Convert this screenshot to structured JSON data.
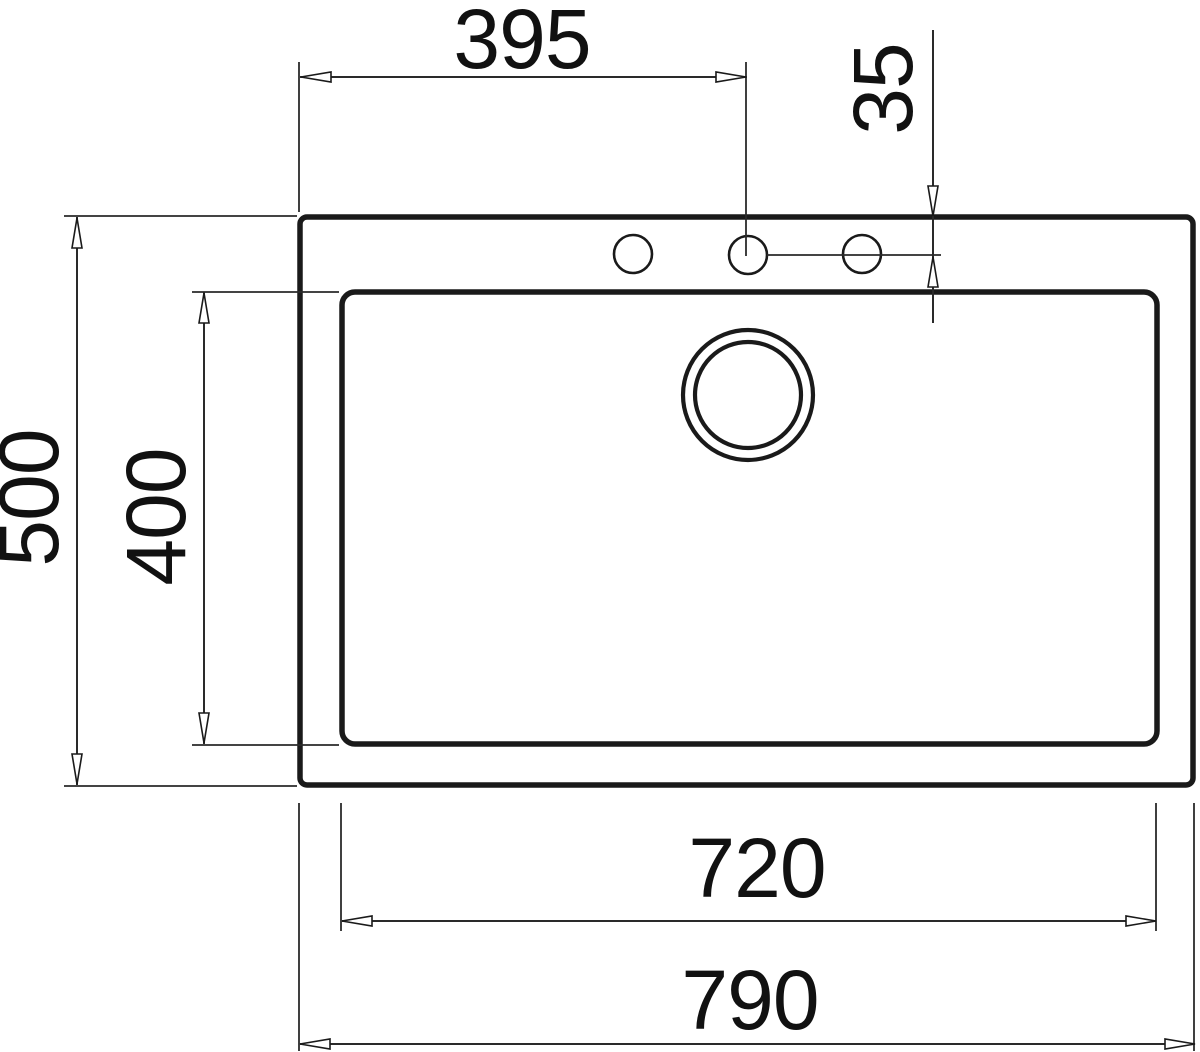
{
  "page": {
    "background": "#ffffff",
    "ink_color": "#1a1a1a"
  },
  "drawing": {
    "subject": "sink-top-view-dimension-drawing",
    "units": "mm",
    "labels": {
      "tap_offset_x": "395",
      "tap_offset_y": "35",
      "overall_depth": "500",
      "basin_depth": "400",
      "basin_width": "720",
      "overall_width": "790"
    }
  }
}
